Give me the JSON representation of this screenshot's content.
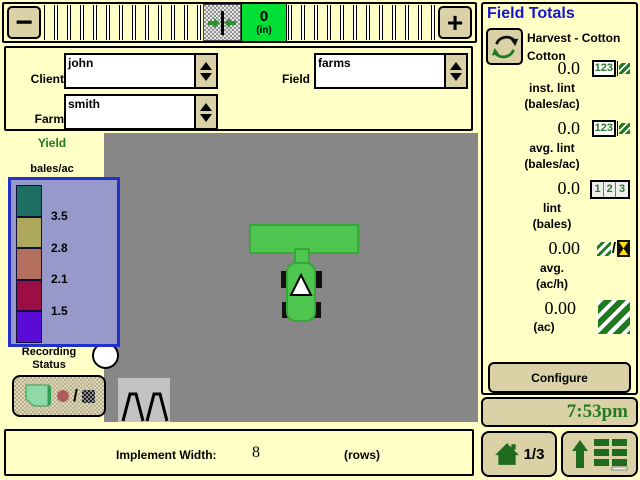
{
  "top_bar": {
    "minus": "−",
    "plus": "+",
    "offset_value": "0",
    "offset_unit": "(in)"
  },
  "selectors": {
    "client": {
      "label": "Client",
      "value": "john"
    },
    "farm": {
      "label": "Farm",
      "value": "smith"
    },
    "field": {
      "label": "Field",
      "value": "farms"
    }
  },
  "legend": {
    "title": "Yield",
    "unit": "bales/ac",
    "values": [
      "3.5",
      "2.8",
      "2.1",
      "1.5"
    ],
    "swatch_colors": [
      "#1d6f62",
      "#ada85b",
      "#b4705e",
      "#9c0f45",
      "#5a0bd6"
    ]
  },
  "recording": {
    "line1": "Recording",
    "line2": "Status"
  },
  "implement": {
    "label": "Implement Width:",
    "value": "8",
    "unit": "(rows)"
  },
  "field_totals": {
    "title": "Field Totals",
    "operation_line1": "Harvest - Cotton",
    "operation_line2": "Cotton",
    "icon_digits": {
      "combined": "123",
      "d1": "1",
      "d2": "2",
      "d3": "3"
    },
    "rows": [
      {
        "value": "0.0",
        "label": "inst. lint",
        "unit": "(bales/ac)"
      },
      {
        "value": "0.0",
        "label": "avg. lint",
        "unit": "(bales/ac)"
      },
      {
        "value": "0.0",
        "label": "lint",
        "unit": "(bales)"
      },
      {
        "value": "0.00",
        "label": "avg.",
        "unit": "(ac/h)"
      },
      {
        "value": "0.00",
        "label": "",
        "unit": "(ac)"
      }
    ],
    "configure": "Configure"
  },
  "status_bar": {
    "time": "7:53pm",
    "page": "1/3"
  },
  "colors": {
    "background": "#ffffc6",
    "button_tan": "#dad2a6",
    "map_gray": "#878787",
    "readout_green": "#00df33",
    "tractor_green": "#4fc64f",
    "title_blue": "#1515cc",
    "deere_green": "#1e6b1e",
    "legend_fill": "#9899cb",
    "legend_border": "#2231cc"
  }
}
